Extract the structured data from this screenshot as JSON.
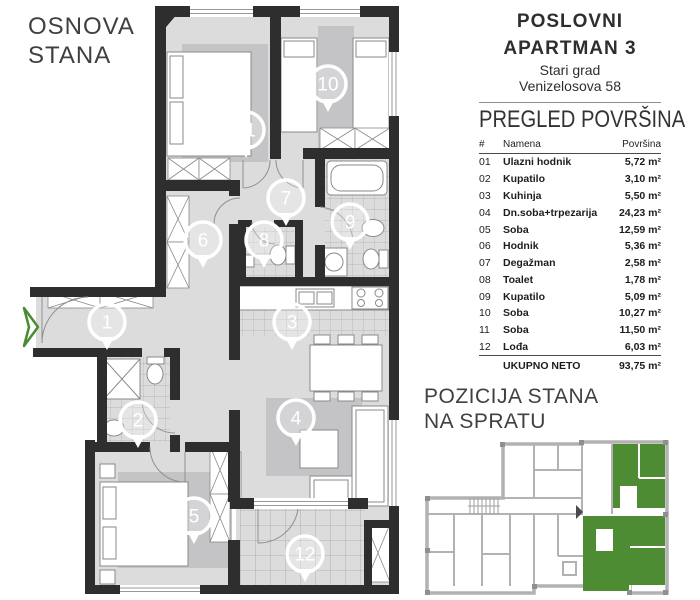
{
  "plan": {
    "title_line1": "OSNOVA",
    "title_line2": "STANA",
    "markers": [
      {
        "n": "1",
        "x": 107,
        "y": 322
      },
      {
        "n": "2",
        "x": 138,
        "y": 420
      },
      {
        "n": "3",
        "x": 292,
        "y": 322
      },
      {
        "n": "4",
        "x": 296,
        "y": 418
      },
      {
        "n": "5",
        "x": 194,
        "y": 516
      },
      {
        "n": "6",
        "x": 203,
        "y": 240
      },
      {
        "n": "7",
        "x": 286,
        "y": 198
      },
      {
        "n": "8",
        "x": 264,
        "y": 240
      },
      {
        "n": "9",
        "x": 350,
        "y": 222
      },
      {
        "n": "10",
        "x": 328,
        "y": 84
      },
      {
        "n": "11",
        "x": 246,
        "y": 130
      },
      {
        "n": "12",
        "x": 305,
        "y": 554
      }
    ]
  },
  "info": {
    "title_line1": "POSLOVNI",
    "title_line2": "APARTMAN 3",
    "subtitle_line1": "Stari grad",
    "subtitle_line2": "Venizelosova 58"
  },
  "areas": {
    "heading": "PREGLED POVRŠINA",
    "col_num": "#",
    "col_name": "Namena",
    "col_area": "Površina",
    "rows": [
      {
        "num": "01",
        "name": "Ulazni hodnik",
        "area": "5,72 m²"
      },
      {
        "num": "02",
        "name": "Kupatilo",
        "area": "3,10 m²"
      },
      {
        "num": "03",
        "name": "Kuhinja",
        "area": "5,50 m²"
      },
      {
        "num": "04",
        "name": "Dn.soba+trpezarija",
        "area": "24,23 m²"
      },
      {
        "num": "05",
        "name": "Soba",
        "area": "12,59 m²"
      },
      {
        "num": "06",
        "name": "Hodnik",
        "area": "5,36 m²"
      },
      {
        "num": "07",
        "name": "Degažman",
        "area": "2,58 m²"
      },
      {
        "num": "08",
        "name": "Toalet",
        "area": "1,78 m²"
      },
      {
        "num": "09",
        "name": "Kupatilo",
        "area": "5,09 m²"
      },
      {
        "num": "10",
        "name": "Soba",
        "area": "10,27 m²"
      },
      {
        "num": "11",
        "name": "Soba",
        "area": "11,50 m²"
      },
      {
        "num": "12",
        "name": "Lođa",
        "area": "6,03 m²"
      }
    ],
    "total_label": "UKUPNO NETO",
    "total_area": "93,75 m²"
  },
  "position": {
    "title_line1": "POZICIJA STANA",
    "title_line2": "NA SPRATU"
  },
  "colors": {
    "accent_green": "#4a8b33",
    "total_green": "#3b7d2a",
    "wall_dark": "#2e2e2e"
  }
}
